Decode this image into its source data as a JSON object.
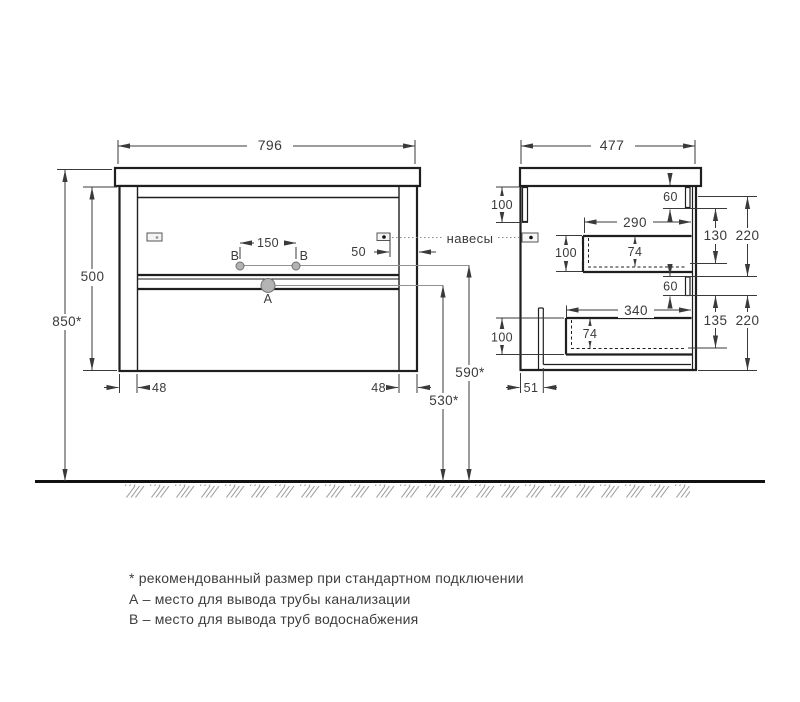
{
  "colors": {
    "outline": "#1f1f1f",
    "dimension": "#3a3a3a",
    "hatch": "#9a9a9a",
    "marker_fill": "#b3b3b3"
  },
  "front": {
    "width": "796",
    "overall_height": "850*",
    "body_height": "500",
    "supply_spacing": "150",
    "bracket_offset": "50",
    "left_panel": "48",
    "right_panel": "48",
    "drain_outlet_height": "530*",
    "supply_outlet_height": "590*",
    "label_a": "A",
    "label_b1": "B",
    "label_b2": "B"
  },
  "side": {
    "depth": "477",
    "mount_rail_height": "100",
    "upper_gap": "60",
    "upper_box_width": "290",
    "upper_box_height": "100",
    "upper_box_depth": "74",
    "upper_offset": "130",
    "upper_front_height": "220",
    "lower_gap": "60",
    "lower_box_width": "340",
    "lower_box_height": "100",
    "lower_box_depth": "74",
    "lower_offset": "135",
    "lower_front_height": "220",
    "back_clearance": "51"
  },
  "hangers_label": "навесы",
  "notes": {
    "asterisk": "* рекомендованный размер при стандартном подключении",
    "a": "А – место для вывода трубы канализации",
    "b": "В – место для вывода труб водоснабжения"
  }
}
